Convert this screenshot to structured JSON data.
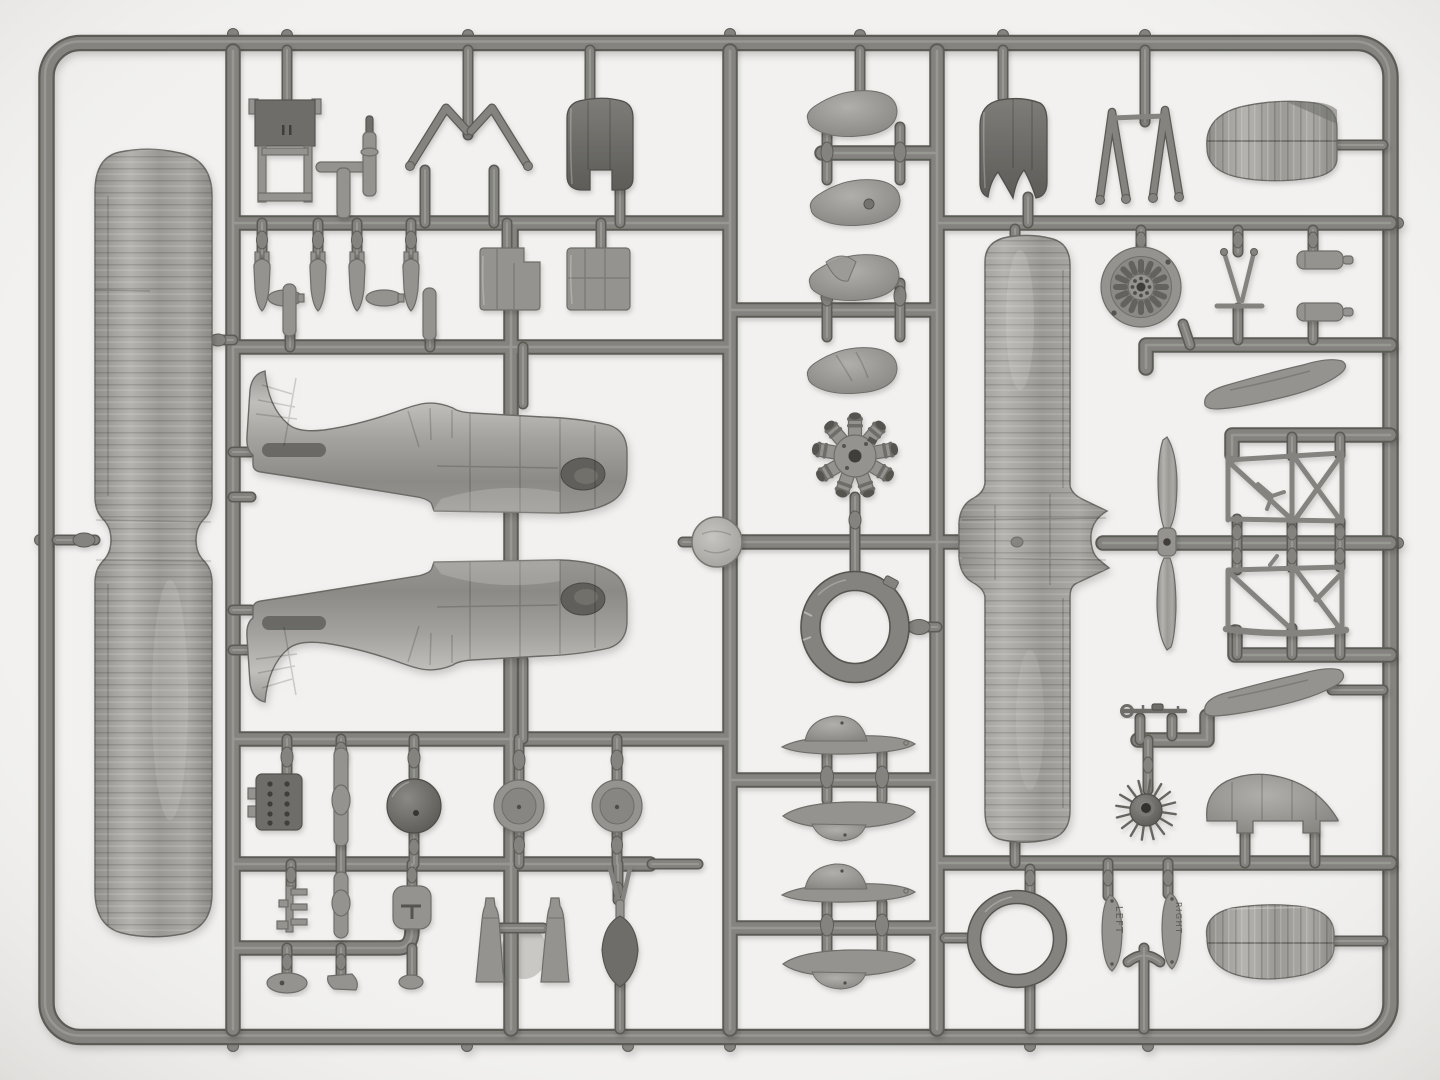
{
  "image_type": "photograph",
  "subject": {
    "description": "Gray injection-molded plastic sprue (parts tree) of a small-scale biplane fighter model kit, photographed flat on a bright white background",
    "orientation": "landscape",
    "material": "gray styrene plastic"
  },
  "labels": {
    "left": "LEFT",
    "right": "RIGHT"
  },
  "colors": {
    "bg": "#f2f1ef",
    "bgEdge": "#e4e3e1",
    "sprue": "#84837f",
    "sprueDk": "#5c5b57",
    "sprueHi": "#b2b1ad",
    "part": "#94938f",
    "partLt": "#b8b7b3",
    "partDk": "#6e6d69",
    "partDkr": "#54534f",
    "shine": "#d8d7d3",
    "hole": "#3f3e3a",
    "emboss": "#4e4d49",
    "blurPart": "#c9c8c4"
  },
  "inventory": [
    {
      "part": "fuselage half",
      "count": 2
    },
    {
      "part": "one-piece lower wing",
      "count": 1
    },
    {
      "part": "one-piece upper wing",
      "count": 1
    },
    {
      "part": "two-blade propeller",
      "count": 1
    },
    {
      "part": "radial engine",
      "count": 1
    },
    {
      "part": "engine cowling ring",
      "count": 1
    },
    {
      "part": "cowling front",
      "count": 2
    },
    {
      "part": "cowling side panel",
      "count": 2
    },
    {
      "part": "small bomb",
      "count": 4
    },
    {
      "part": "wheel spat teardrop half",
      "count": 4
    },
    {
      "part": "wheel spat upper/lower half",
      "count": 4
    },
    {
      "part": "main wheel disc",
      "count": 2
    },
    {
      "part": "spoked wheel",
      "count": 1
    },
    {
      "part": "wire-spoke wheel",
      "count": 1
    },
    {
      "part": "stabilizer half",
      "count": 2
    },
    {
      "part": "landing gear V-strut",
      "count": 2
    },
    {
      "part": "cabane strut",
      "count": 2
    },
    {
      "part": "cockpit truss frame",
      "count": 2
    },
    {
      "part": "small ring",
      "count": 1
    },
    {
      "part": "windshield fairing",
      "count": 1
    },
    {
      "part": "tail fairing boot",
      "count": 2
    },
    {
      "part": "machine gun",
      "count": 1
    },
    {
      "part": "exhaust cone",
      "count": 2
    },
    {
      "part": "blade tag marked LEFT",
      "count": 1
    },
    {
      "part": "blade tag marked RIGHT",
      "count": 1
    }
  ]
}
